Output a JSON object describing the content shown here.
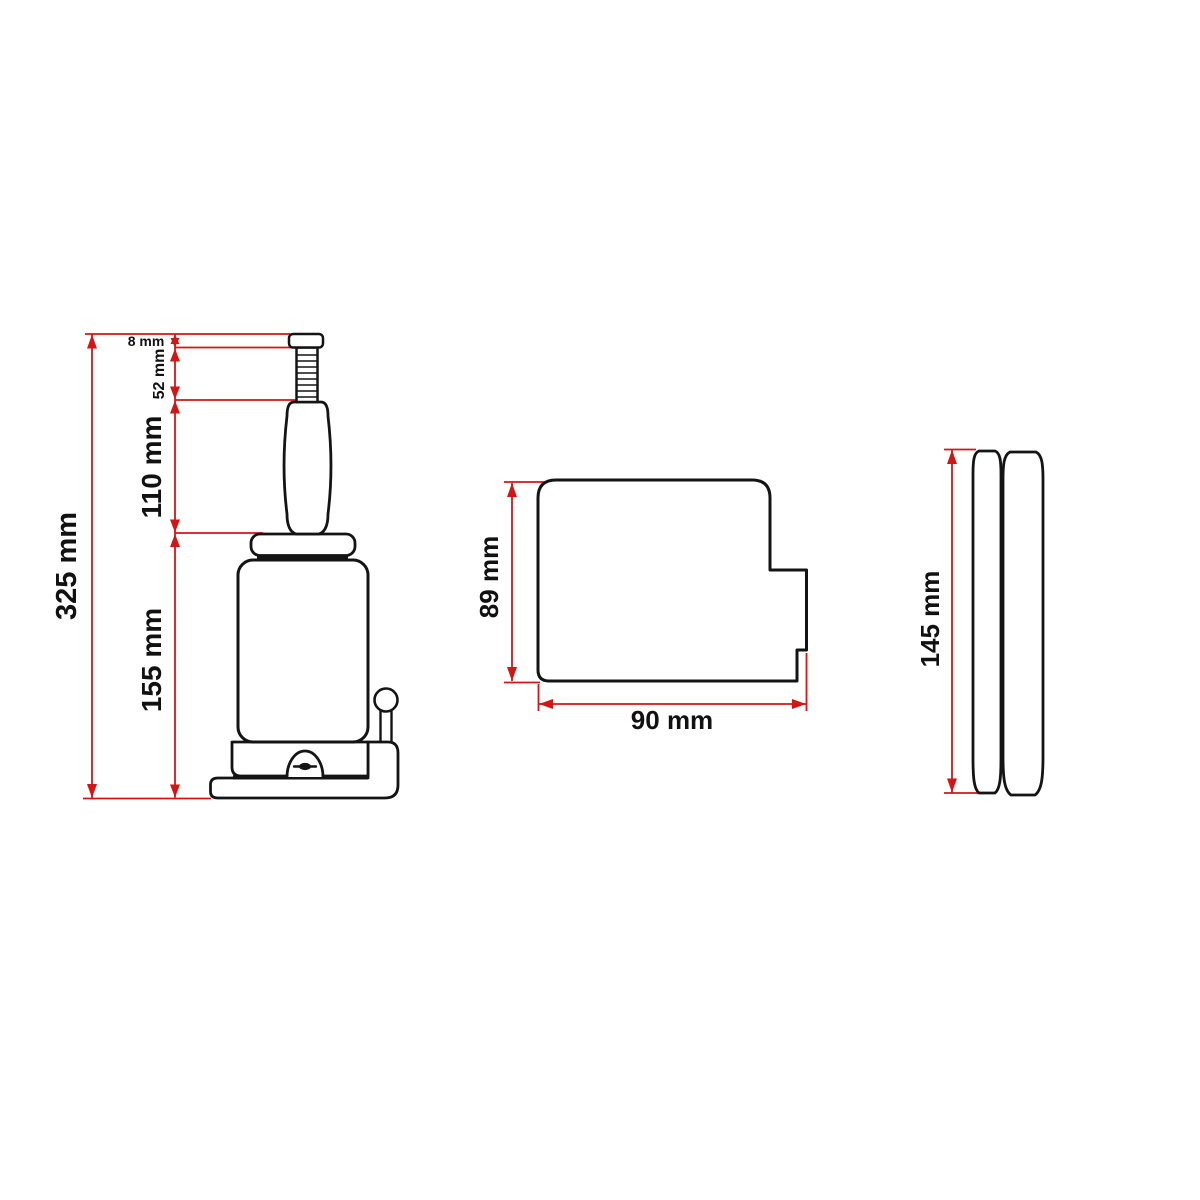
{
  "drawing": {
    "background": "#ffffff",
    "outline_color": "#141414",
    "dimension_color": "#d21616"
  },
  "dims": {
    "total_height": "325 mm",
    "saddle_screw_cap": "8 mm",
    "extension_screw": "52 mm",
    "lift_ram": "110 mm",
    "body_height": "155 mm",
    "base_depth": "89 mm",
    "base_width": "90 mm",
    "handle_length": "145 mm"
  }
}
